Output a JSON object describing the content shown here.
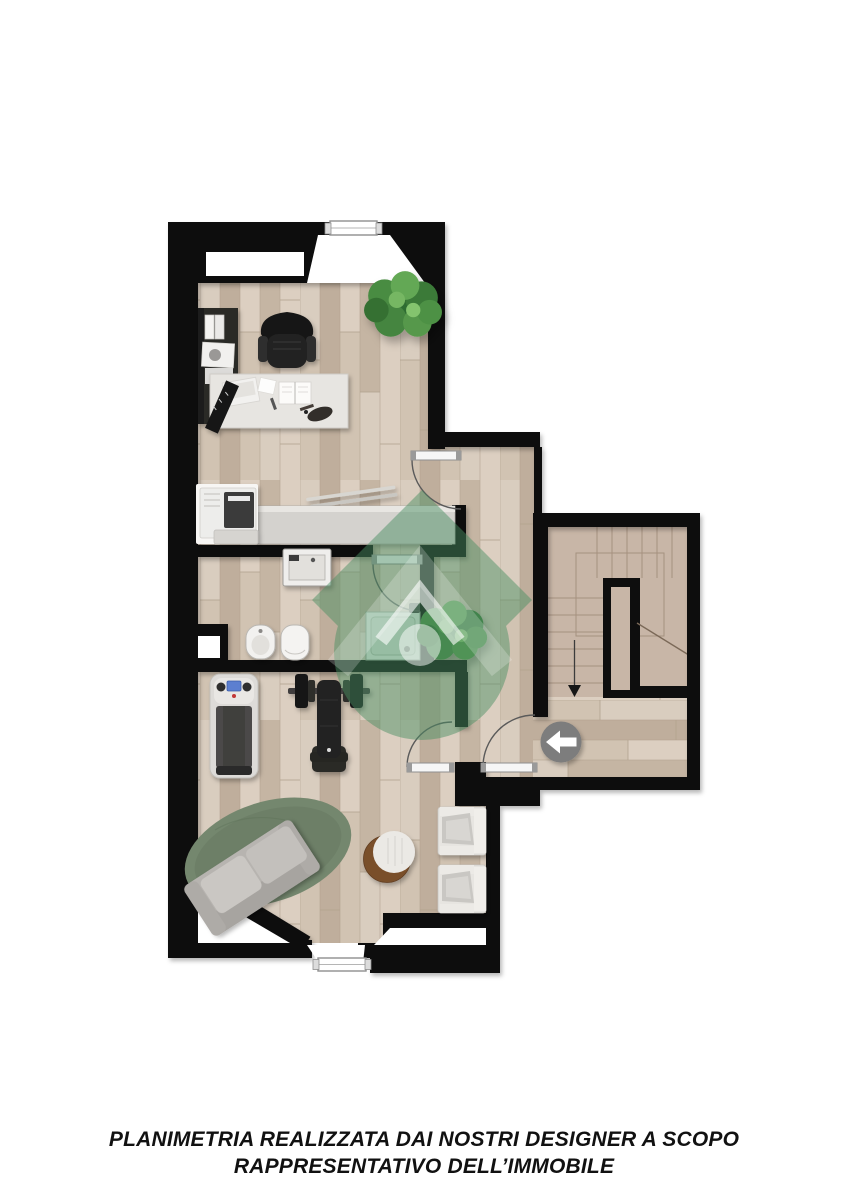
{
  "disclaimer": {
    "line1": "PLANIMETRIA REALIZZATA DAI NOSTRI DESIGNER A SCOPO",
    "line2": "RAPPRESENTATIVO DELL’IMMOBILE"
  },
  "palette": {
    "background": "#ffffff",
    "text": "#111111",
    "wall": "#0e0e0e",
    "plank_1": "#d9cdbf",
    "plank_2": "#c5b5a3",
    "plank_3": "#d1c3b2",
    "plank_4": "#bfae9c",
    "plank_5": "#dccfc1",
    "plank_gap": "#b2a28f",
    "stair_floor": "#c8b6a7",
    "stair_line": "#a5917f",
    "watermark_green": "#4a8f63",
    "rug_green": "#74876e",
    "entry_circle": "#7d7d7d",
    "table_wood": "#7a4f2c",
    "door_arc": "#5a5a5a"
  },
  "icons": {
    "entry_arrow": "left-arrow-in-circle",
    "stair_arrow": "down-arrow",
    "watermark": "house-in-diamond-logo",
    "plants": "potted-plant"
  }
}
